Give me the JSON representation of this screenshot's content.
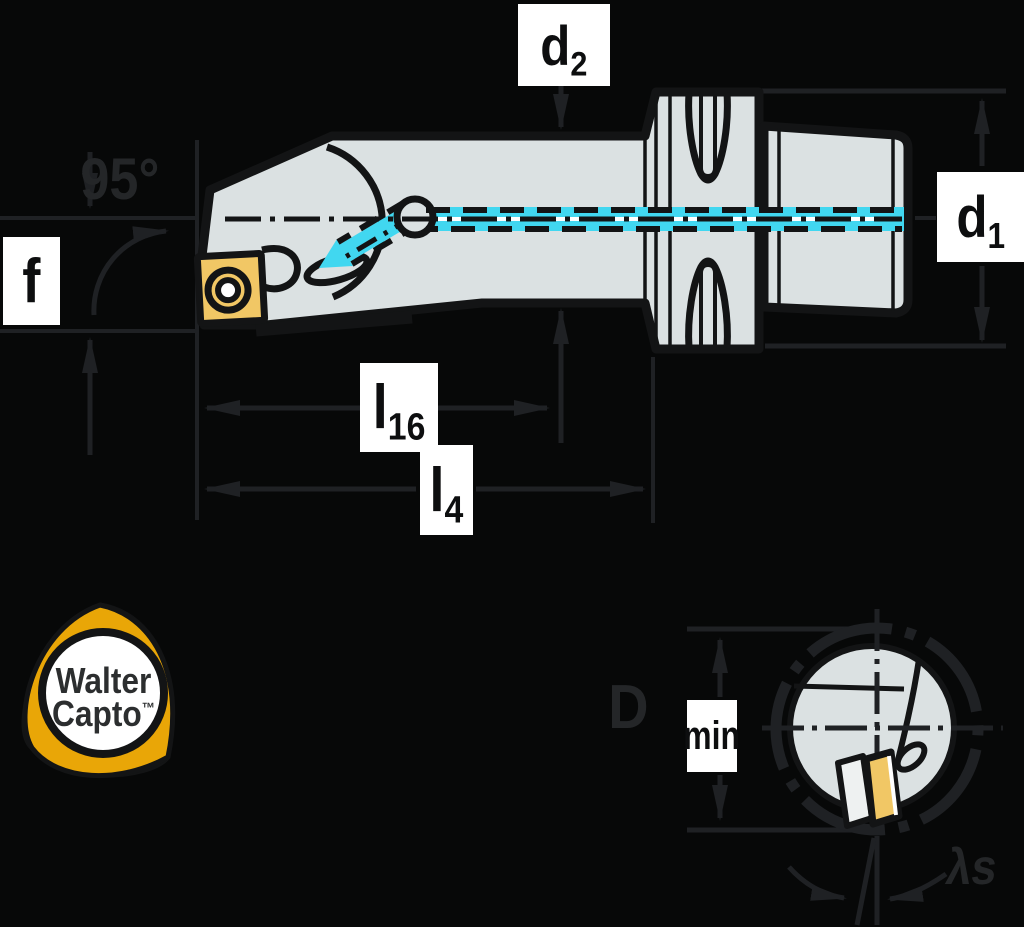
{
  "colors": {
    "bg": "#070808",
    "line": "#1f2124",
    "textdim": "#242628",
    "outline": "#131415",
    "body": "#dbe1e2",
    "coolant": "#41d7f0",
    "insert": "#f1c765",
    "labelbg": "#ffffff",
    "labelfg": "#0d0e0f",
    "logoyellow": "#e9a607",
    "logofg": "#2c2e2f",
    "white": "#ffffff"
  },
  "labels": {
    "d2": {
      "base": "d",
      "sub": "2"
    },
    "d1": {
      "base": "d",
      "sub": "1"
    },
    "f": {
      "base": "f"
    },
    "angle": {
      "text": "95°"
    },
    "l16": {
      "base": "l",
      "sub": "16"
    },
    "l4": {
      "base": "l",
      "sub": "4"
    },
    "dmin": {
      "base": "D",
      "sub": "min"
    },
    "lambda": {
      "text": "λs"
    }
  },
  "logo": {
    "line1": "Walter",
    "line2": "Capto",
    "trademark": "™"
  }
}
